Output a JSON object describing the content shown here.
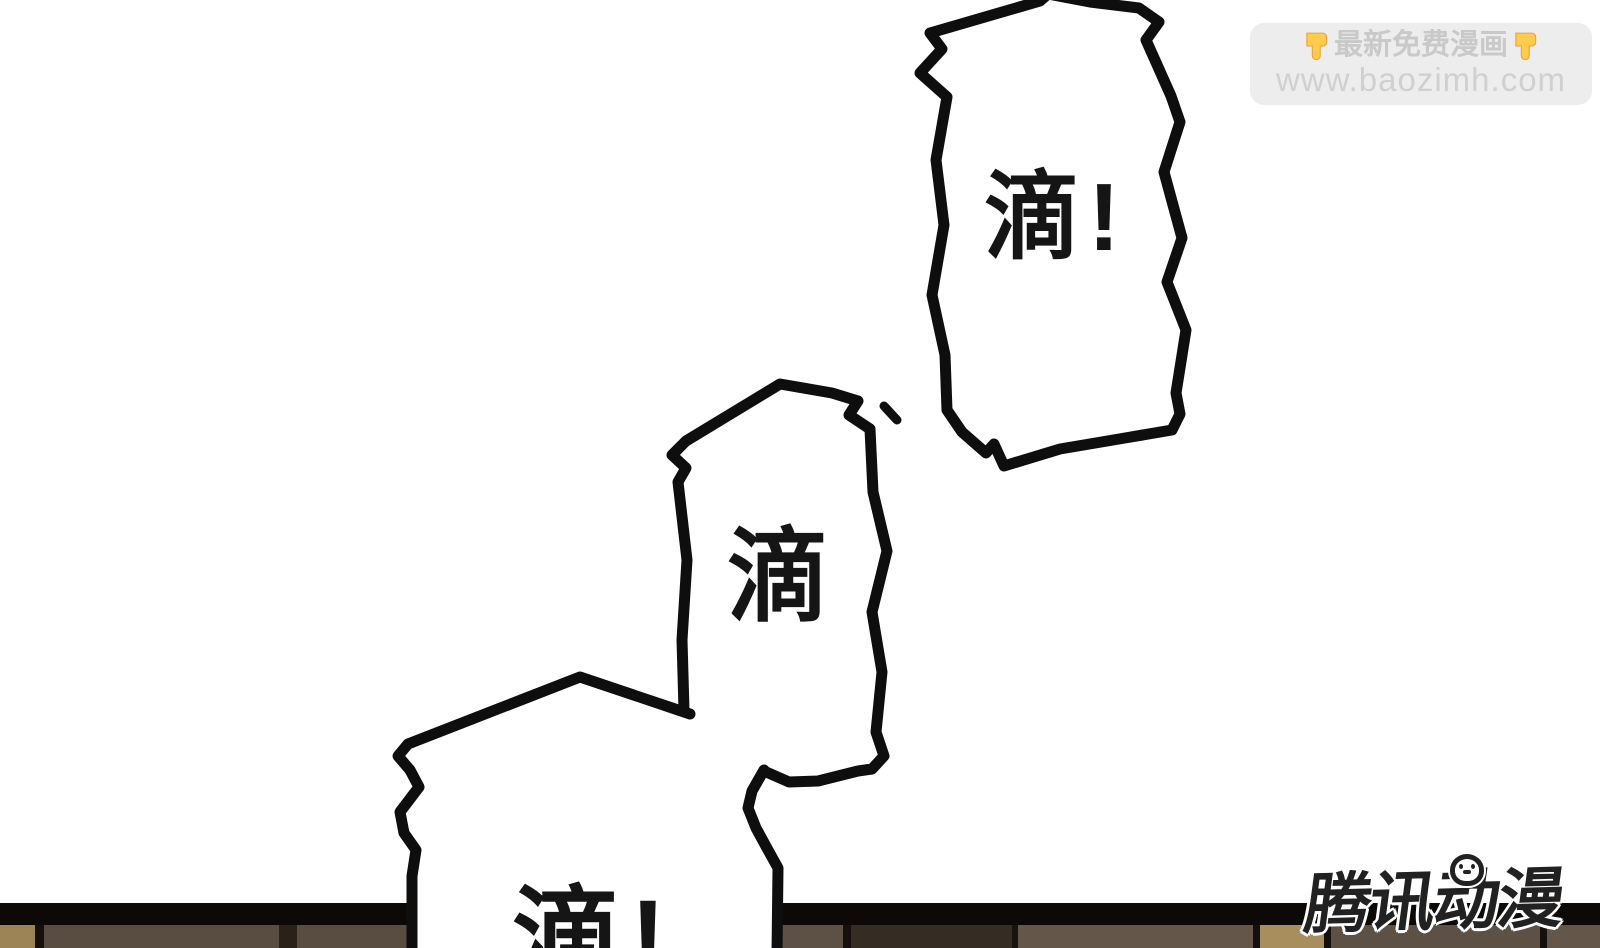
{
  "comic": {
    "speech_bubbles": [
      {
        "id": "bubble-1",
        "text": "滴!"
      },
      {
        "id": "bubble-2",
        "text": "滴"
      },
      {
        "id": "bubble-3",
        "text": "滴!"
      }
    ]
  },
  "watermark": {
    "line1_text": "最新免费漫画",
    "line1_icon": "pointing-down-emoji",
    "pointing_down_icon_char": "👇",
    "line2_text": "www.baozimh.com",
    "bg_color": "#ececec",
    "text_color": "#c9c9c9",
    "emoji_color": "#ffcb4c"
  },
  "publisher_logo": {
    "text": "腾讯动漫",
    "color": "#212121",
    "outline_color": "#ffffff"
  },
  "floor": {
    "band_color": "#0c0906",
    "panels": [
      {
        "x": 0,
        "w": 35,
        "color": "#9c8456"
      },
      {
        "x": 35,
        "w": 9,
        "color": "#15100b"
      },
      {
        "x": 44,
        "w": 235,
        "color": "#594c41"
      },
      {
        "x": 279,
        "w": 18,
        "color": "#2a2119"
      },
      {
        "x": 297,
        "w": 113,
        "color": "#594c41"
      },
      {
        "x": 770,
        "w": 73,
        "color": "#5d5044"
      },
      {
        "x": 843,
        "w": 8,
        "color": "#15100b"
      },
      {
        "x": 851,
        "w": 161,
        "color": "#352c23"
      },
      {
        "x": 1012,
        "w": 6,
        "color": "#1a140e"
      },
      {
        "x": 1018,
        "w": 235,
        "color": "#645749"
      },
      {
        "x": 1253,
        "w": 7,
        "color": "#15100b"
      },
      {
        "x": 1260,
        "w": 64,
        "color": "#a78e5c"
      },
      {
        "x": 1324,
        "w": 7,
        "color": "#15100b"
      },
      {
        "x": 1331,
        "w": 209,
        "color": "#5d5044"
      },
      {
        "x": 1540,
        "w": 7,
        "color": "#15100b"
      },
      {
        "x": 1547,
        "w": 53,
        "color": "#645749"
      }
    ]
  }
}
